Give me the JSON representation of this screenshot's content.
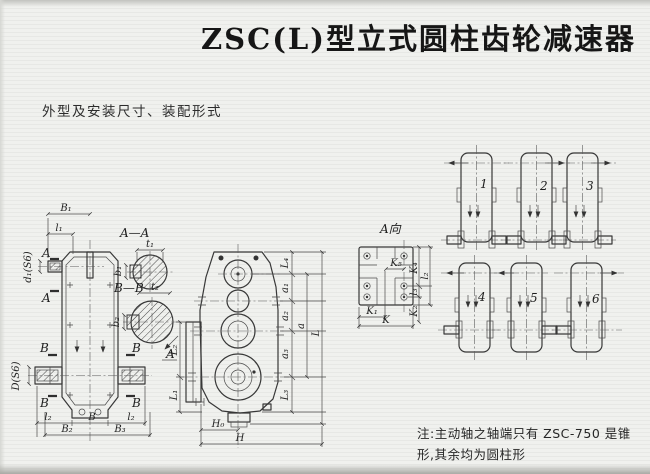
{
  "page": {
    "title": "ZSC(L)型立式圆柱齿轮减速器",
    "subtitle": "外型及安装尺寸、装配形式",
    "note_line1": "注:主动轴之轴端只有 ZSC-750 是锥",
    "note_line2": "形,其余均为圆柱形"
  },
  "colors": {
    "paper": "#f0f1ee",
    "ink": "#2c2c2c",
    "line": "#383838"
  },
  "front_view": {
    "b1": "B₁",
    "l1": "l₁",
    "d1": "d₁(S6)",
    "D": "D(S6)",
    "a_top": "A",
    "a_bottom": "A",
    "b_tl": "B",
    "b_bl": "B",
    "b_tr": "B",
    "b_br": "B",
    "l2_left": "l₂",
    "b_base": "B",
    "l2_right": "l₂",
    "b2": "B₂",
    "b3": "B₃"
  },
  "section_aa": {
    "title": "A—A",
    "t1": "t₁",
    "b1": "b₁"
  },
  "section_bb": {
    "title": "B—B",
    "t2": "t₂",
    "b2": "b₂",
    "view_arrow_label": "A"
  },
  "side_view": {
    "L4": "L₄",
    "a1": "a₁",
    "a2": "a₂",
    "a3": "a₃",
    "a": "a",
    "L3": "L₃",
    "L": "L",
    "L2": "L₂",
    "L1": "L₁",
    "H0": "H₀",
    "H": "H"
  },
  "view_a": {
    "title": "A向",
    "K5": "K₅",
    "K4": "K₄",
    "l3": "l₃",
    "l2": "l₂",
    "K1": "K₁",
    "K": "K",
    "K2": "K₂"
  },
  "assembly": {
    "nums": [
      "1",
      "2",
      "3",
      "4",
      "5",
      "6"
    ]
  }
}
